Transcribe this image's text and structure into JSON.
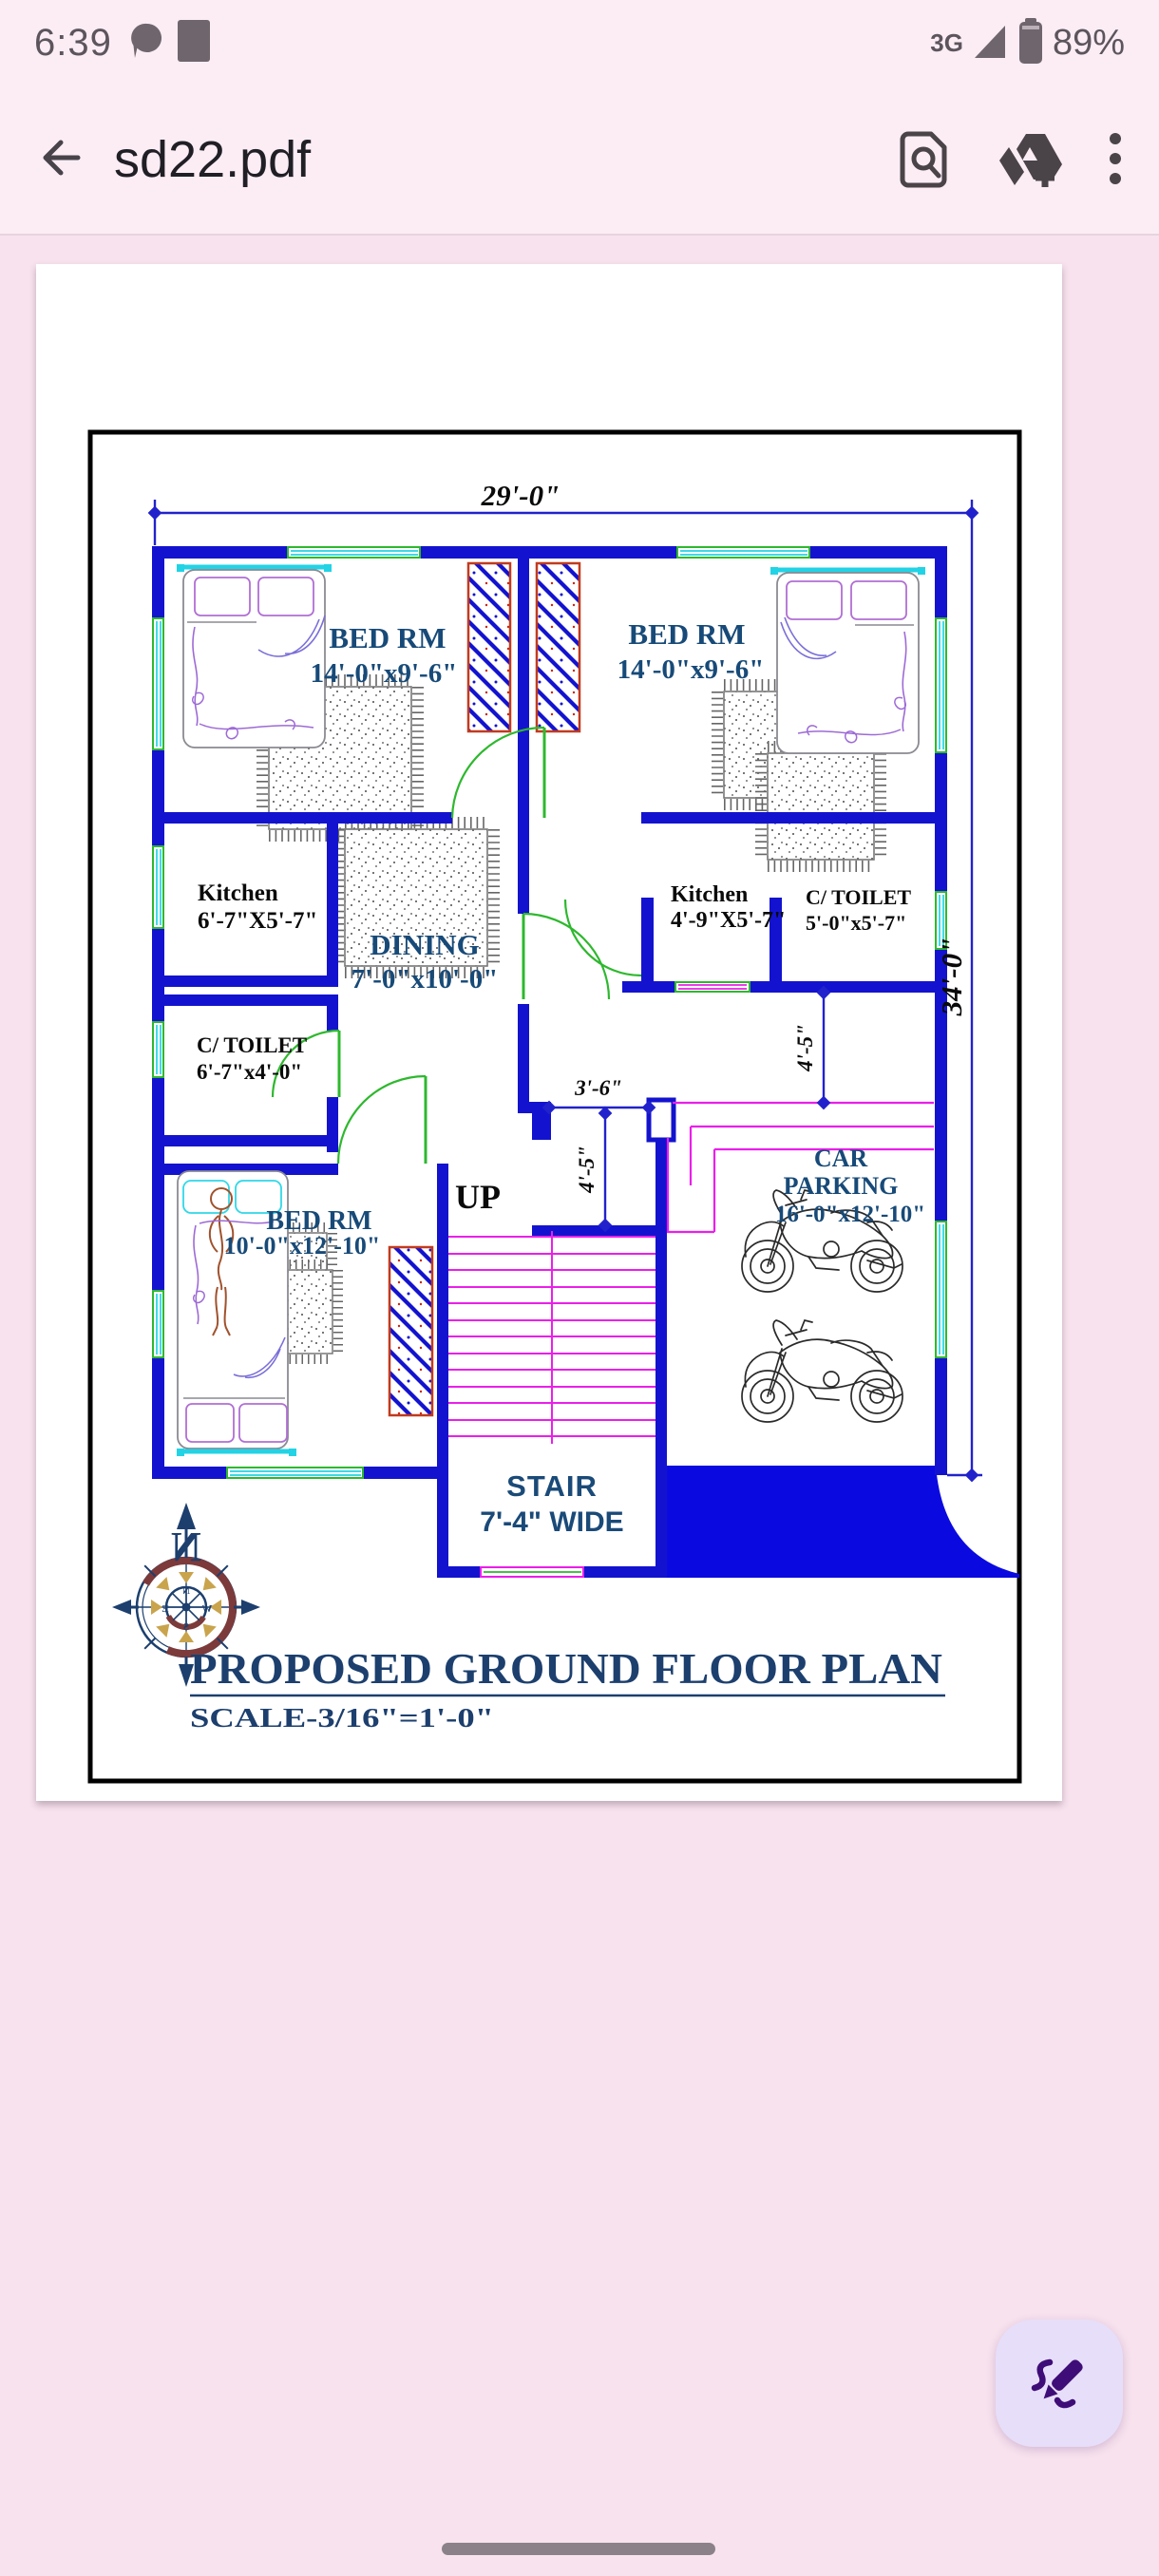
{
  "status_bar": {
    "time": "6:39",
    "network": "3G",
    "battery": "89%"
  },
  "app_bar": {
    "title": "sd22.pdf"
  },
  "plan": {
    "title": "PROPOSED GROUND FLOOR PLAN",
    "scale": "SCALE-3/16\"=1'-0\"",
    "compass": {
      "north": "N",
      "n": "N",
      "e": "E",
      "s": "S",
      "w": "W"
    },
    "dims": {
      "width": "29'-0\"",
      "height": "34'-0\"",
      "hall_w": "3'-6\"",
      "hall_h": "4'-5\"",
      "porch": "4'-5\""
    },
    "rooms": {
      "bed1": {
        "name": "BED RM",
        "size": "14'-0\"x9'-6\""
      },
      "bed2": {
        "name": "BED RM",
        "size": "14'-0\"x9'-6\""
      },
      "bed3": {
        "name": "BED RM",
        "size": "10'-0\"x12'-10\""
      },
      "kitchen1": {
        "name": "Kitchen",
        "size": "6'-7\"X5'-7\""
      },
      "kitchen2": {
        "name": "Kitchen",
        "size": "4'-9\"X5'-7\""
      },
      "toilet1": {
        "name": "C/ TOILET",
        "size": "6'-7\"x4'-0\""
      },
      "toilet2": {
        "name": "C/ TOILET",
        "size": "5'-0\"x5'-7\""
      },
      "dining": {
        "name": "DINING",
        "size": "7'-0\"x10'-0\""
      },
      "parking": {
        "line1": "CAR",
        "line2": "PARKING",
        "size": "16'-0\"x12'-10\""
      },
      "stair": {
        "name": "STAIR",
        "size": "7'-4\" WIDE",
        "up": "UP"
      }
    }
  },
  "colors": {
    "wall_blue": "#1313cf",
    "window_green": "#2eb82e",
    "window_cyan": "#22d3e5",
    "magenta": "#ea1fea",
    "navy_text": "#174a78",
    "title_navy": "#1c3f6e",
    "hatch_border": "#c23a1e",
    "ramp_blue": "#0a0ae0",
    "fab_bg": "#e7def9",
    "fab_icon": "#3f0d77",
    "app_bg": "#fcedf5",
    "content_bg": "#f8e2ee"
  }
}
